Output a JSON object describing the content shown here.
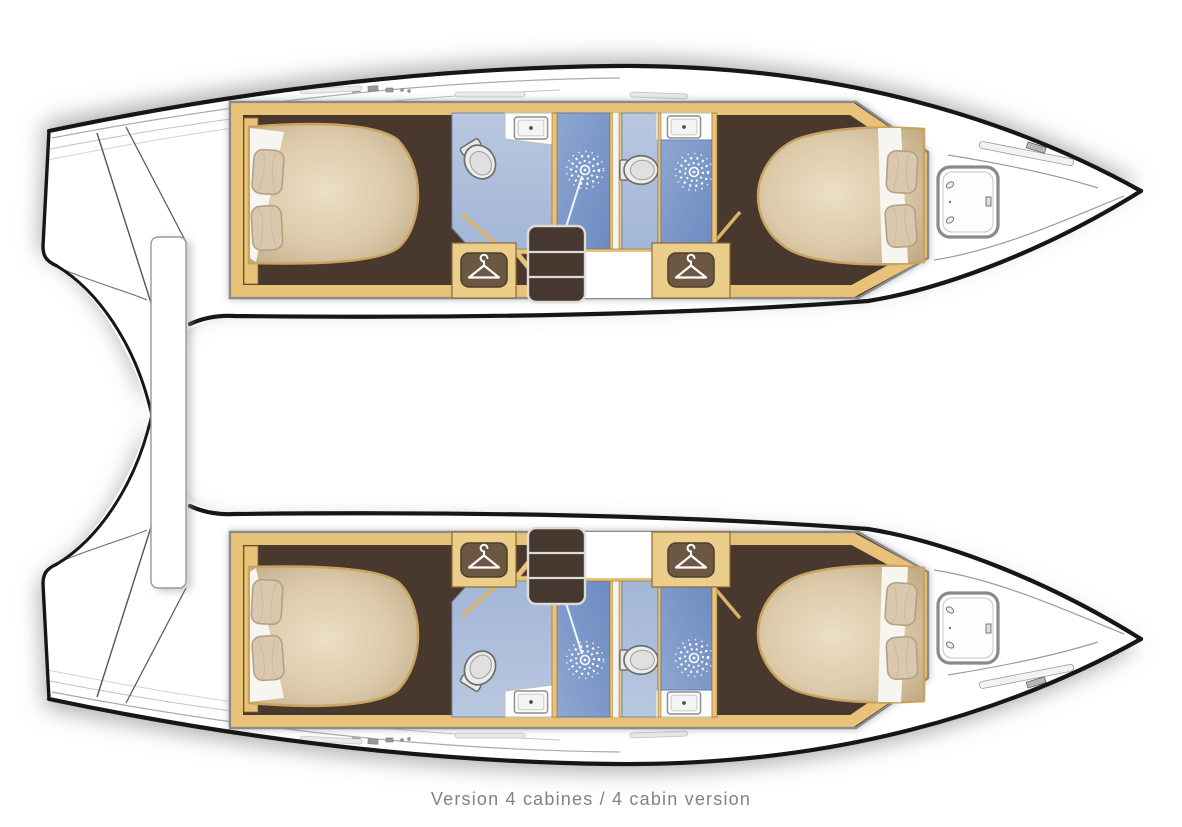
{
  "caption": "Version 4 cabines / 4 cabin version",
  "diagram": {
    "type": "boat-floor-plan",
    "boat_type": "catamaran",
    "layout_label": "4 cabin version",
    "hull_count": 2,
    "hulls": [
      {
        "name": "port-hull",
        "rooms": [
          "aft-double-cabin",
          "aft-bathroom",
          "aft-shower",
          "forward-bathroom",
          "forward-shower",
          "forward-double-cabin"
        ],
        "features": [
          "transom-steps",
          "wardrobe-aft",
          "wardrobe-forward",
          "companionway-stairs",
          "bow-hatch",
          "double-bed-aft",
          "double-bed-forward"
        ]
      },
      {
        "name": "starboard-hull",
        "rooms": [
          "aft-double-cabin",
          "aft-bathroom",
          "aft-shower",
          "forward-bathroom",
          "forward-shower",
          "forward-double-cabin"
        ],
        "features": [
          "transom-steps",
          "wardrobe-aft",
          "wardrobe-forward",
          "companionway-stairs",
          "bow-hatch",
          "double-bed-aft",
          "double-bed-forward"
        ]
      }
    ],
    "icons": [
      "hanger-icon",
      "shower-rose-icon",
      "toilet-icon",
      "sink-icon",
      "bow-hatch-icon",
      "pillow-icon"
    ],
    "colors": {
      "hull_outline": "#1a1a1a",
      "deck_white": "#ffffff",
      "wood_trim": "#e8c279",
      "wood_trim_edge": "#8a6a33",
      "cabin_floor_dark": "#4a392e",
      "bed_beige_light": "#e9dcc0",
      "bed_beige_dark": "#c7b28e",
      "bathroom_blue": "#aebfda",
      "shower_blue": "#7b97c8",
      "caption_gray": "#828282",
      "border_gray": "#8a8a8a"
    }
  }
}
